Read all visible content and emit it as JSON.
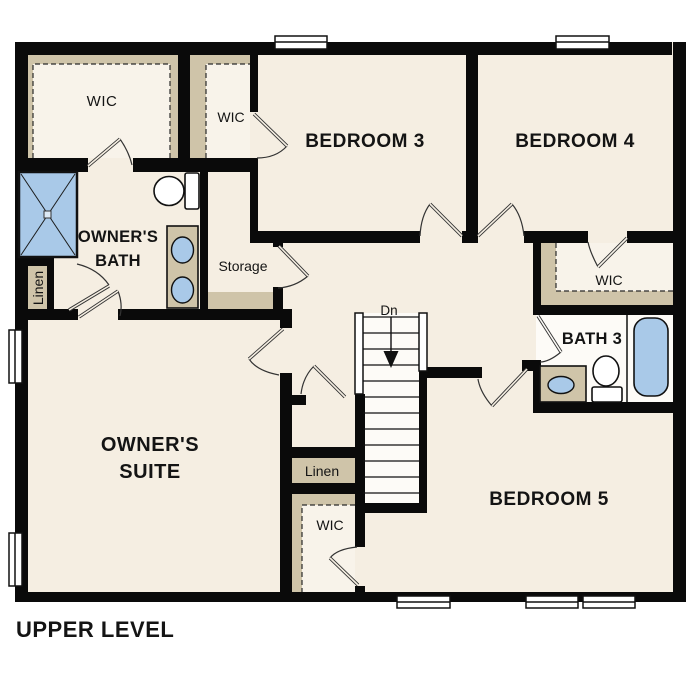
{
  "plan": {
    "title": "UPPER LEVEL",
    "labels": {
      "wic_owners": "WIC",
      "wic_hall": "WIC",
      "bedroom3": "BEDROOM 3",
      "bedroom4": "BEDROOM 4",
      "owners_bath_line1": "OWNER'S",
      "owners_bath_line2": "BATH",
      "storage": "Storage",
      "linen_left": "Linen",
      "owners_suite_line1": "OWNER'S",
      "owners_suite_line2": "SUITE",
      "stairs_down": "Dn",
      "linen_center": "Linen",
      "wic_bedroom5": "WIC",
      "wic_bedroom4": "WIC",
      "bath3": "BATH 3",
      "bedroom5": "BEDROOM 5"
    },
    "colors": {
      "background": "#ffffff",
      "floor": "#f5eee2",
      "closet_tan": "#cfc4a9",
      "fixture_blue": "#a9c9e8",
      "wall": "#0a0a0a"
    }
  }
}
